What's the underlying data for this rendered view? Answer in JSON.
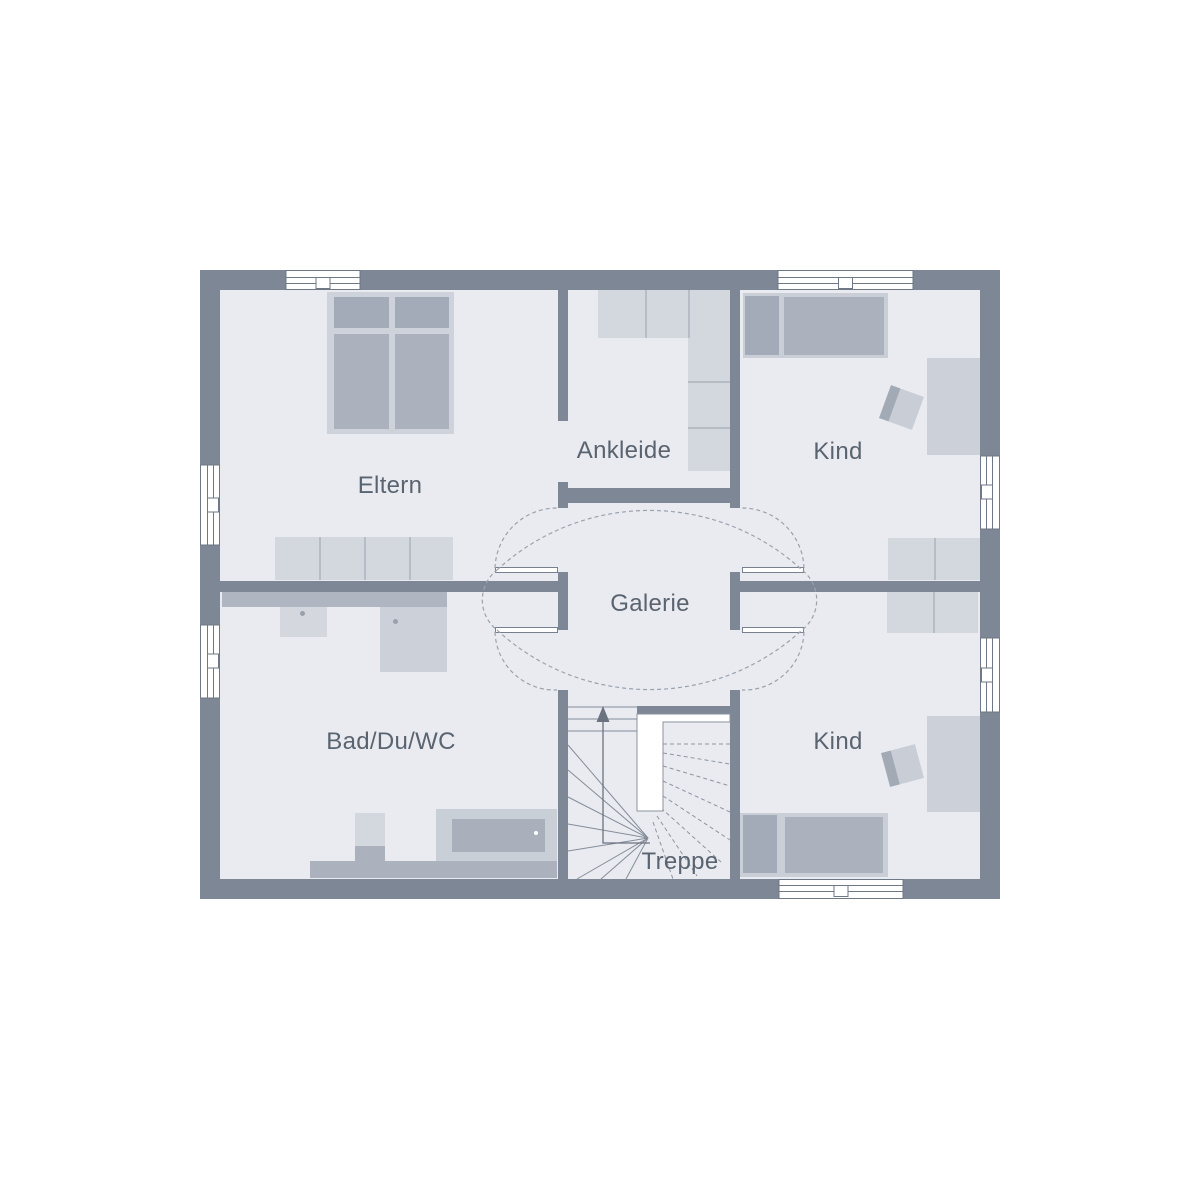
{
  "plan_type": "floor-plan",
  "rooms": {
    "eltern": {
      "label": "Eltern"
    },
    "ankleide": {
      "label": "Ankleide"
    },
    "kind_top": {
      "label": "Kind"
    },
    "galerie": {
      "label": "Galerie"
    },
    "bad": {
      "label": "Bad/Du/WC"
    },
    "kind_bottom": {
      "label": "Kind"
    },
    "treppe": {
      "label": "Treppe"
    }
  },
  "colors": {
    "background": "#ffffff",
    "wall": "#7e8795",
    "floor": "#e9ebf0",
    "furniture_light": "#d3d7de",
    "furniture_mid": "#ccd1d9",
    "furniture_dark": "#abb2be",
    "counter": "#b0b6c1",
    "label_text": "#5a6470",
    "dashed_lines": "#9aa2ae",
    "stair_lines": "#848d9a"
  }
}
